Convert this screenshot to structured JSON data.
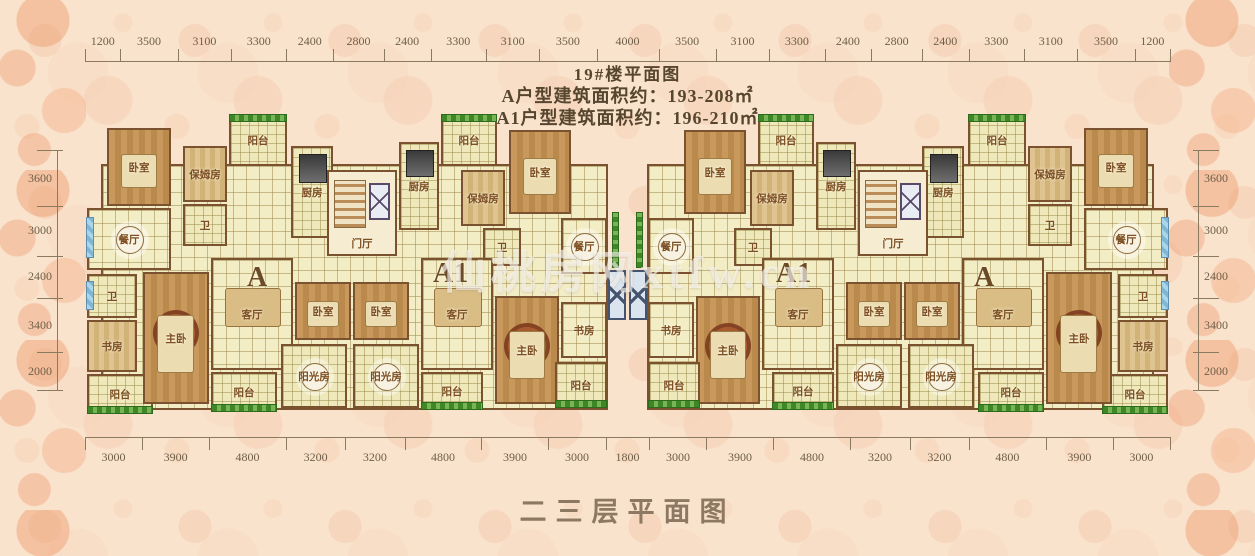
{
  "title": {
    "line1": "19#楼平面图",
    "line2": "A户型建筑面积约：193-208㎡",
    "line3": "A1户型建筑面积约：196-210㎡"
  },
  "footer_title": "二三层平面图",
  "watermark": "仙桃房网xtfw.cn",
  "palette": {
    "background": "#f9e3cd",
    "pattern": "#eca27a",
    "wall": "#7b5230",
    "tile_floor": "#f3edc6",
    "wood_floor": "#c8985c",
    "plant_green": "#3e8726",
    "window_blue": "#8cc4dd",
    "dimension_text": "#6f5f48",
    "title_text": "#57462f",
    "watermark_color": "#faf8f4"
  },
  "dimensions": {
    "top": [
      1200,
      3500,
      3100,
      3300,
      2400,
      2800,
      2400,
      3300,
      3100,
      3500,
      4000,
      3500,
      3100,
      3300,
      2400,
      2800,
      2400,
      3300,
      3100,
      3500,
      1200
    ],
    "bottom": [
      3000,
      3900,
      4800,
      3200,
      3200,
      4800,
      3900,
      3000,
      1800,
      3000,
      3900,
      4800,
      3200,
      3200,
      4800,
      3900,
      3000
    ],
    "left": [
      3600,
      3000,
      2400,
      3400,
      2000
    ],
    "right": [
      3600,
      3000,
      2400,
      3400,
      2000
    ]
  },
  "plan": {
    "width": 1085,
    "height": 318,
    "mirrored": true,
    "base": [
      {
        "n": "unit-base",
        "x": 16,
        "y": 52,
        "w": 507,
        "h": 246,
        "f": "tile"
      }
    ],
    "rooms": [
      {
        "n": "bedroom-nw",
        "x": 22,
        "y": 16,
        "w": 64,
        "h": 78,
        "f": "wood",
        "label": "卧室",
        "furn": "bed"
      },
      {
        "n": "nanny-a",
        "x": 98,
        "y": 34,
        "w": 44,
        "h": 56,
        "f": "woodl",
        "label": "保姆房"
      },
      {
        "n": "bath-a-top",
        "x": 98,
        "y": 92,
        "w": 44,
        "h": 42,
        "f": "tilesm",
        "label": "卫"
      },
      {
        "n": "balcony-a-top",
        "x": 144,
        "y": 2,
        "w": 58,
        "h": 52,
        "f": "tilesm",
        "label": "阳台",
        "plants": "top"
      },
      {
        "n": "kitchen-a",
        "x": 206,
        "y": 34,
        "w": 42,
        "h": 92,
        "f": "tilesm",
        "label": "厨房",
        "furn": "stove"
      },
      {
        "n": "dining-a",
        "x": 2,
        "y": 96,
        "w": 84,
        "h": 62,
        "f": "tile",
        "label": "餐厅",
        "furn": "rtable",
        "window": "left"
      },
      {
        "n": "bath-a-west",
        "x": 2,
        "y": 162,
        "w": 50,
        "h": 44,
        "f": "tilesm",
        "label": "卫",
        "window": "left"
      },
      {
        "n": "study-a",
        "x": 2,
        "y": 208,
        "w": 50,
        "h": 52,
        "f": "woodl",
        "label": "书房"
      },
      {
        "n": "balcony-a-sw",
        "x": 2,
        "y": 262,
        "w": 66,
        "h": 40,
        "f": "tilesm",
        "label": "阳台",
        "plants": "bottom"
      },
      {
        "n": "master-a",
        "x": 58,
        "y": 160,
        "w": 66,
        "h": 132,
        "f": "wood",
        "label": "主卧",
        "furn": "rug+bed"
      },
      {
        "n": "living-a",
        "x": 126,
        "y": 146,
        "w": 82,
        "h": 112,
        "f": "tile",
        "label": "客厅",
        "furn": "sofa"
      },
      {
        "n": "balcony-a-sc",
        "x": 126,
        "y": 260,
        "w": 66,
        "h": 40,
        "f": "tilesm",
        "label": "阳台",
        "plants": "bottom"
      },
      {
        "n": "bedroom-a-south",
        "x": 210,
        "y": 170,
        "w": 56,
        "h": 58,
        "f": "wood",
        "label": "卧室",
        "furn": "bed"
      },
      {
        "n": "sunroom-a",
        "x": 196,
        "y": 232,
        "w": 66,
        "h": 64,
        "f": "tilesm",
        "label": "阳光房",
        "furn": "rtable"
      },
      {
        "n": "entry-core",
        "x": 242,
        "y": 58,
        "w": 70,
        "h": 86,
        "f": "core",
        "label": "门厅",
        "furn": "stairs+xbox"
      },
      {
        "n": "kitchen-a1",
        "x": 314,
        "y": 30,
        "w": 40,
        "h": 88,
        "f": "tilesm",
        "label": "厨房",
        "furn": "stove"
      },
      {
        "n": "balcony-a1-top",
        "x": 356,
        "y": 2,
        "w": 56,
        "h": 52,
        "f": "tilesm",
        "label": "阳台",
        "plants": "top"
      },
      {
        "n": "nanny-a1",
        "x": 376,
        "y": 58,
        "w": 44,
        "h": 56,
        "f": "woodl",
        "label": "保姆房"
      },
      {
        "n": "bath-a1",
        "x": 398,
        "y": 116,
        "w": 38,
        "h": 38,
        "f": "tilesm",
        "label": "卫"
      },
      {
        "n": "bedroom-a1-north",
        "x": 424,
        "y": 18,
        "w": 62,
        "h": 84,
        "f": "wood",
        "label": "卧室",
        "furn": "bed"
      },
      {
        "n": "dining-a1",
        "x": 476,
        "y": 106,
        "w": 46,
        "h": 56,
        "f": "tile",
        "label": "餐厅",
        "furn": "rtable"
      },
      {
        "n": "bedroom-a1-south",
        "x": 268,
        "y": 170,
        "w": 56,
        "h": 58,
        "f": "wood",
        "label": "卧室",
        "furn": "bed"
      },
      {
        "n": "sunroom-a1",
        "x": 268,
        "y": 232,
        "w": 66,
        "h": 64,
        "f": "tilesm",
        "label": "阳光房",
        "furn": "rtable"
      },
      {
        "n": "living-a1",
        "x": 336,
        "y": 146,
        "w": 72,
        "h": 112,
        "f": "tile",
        "label": "客厅",
        "furn": "sofa"
      },
      {
        "n": "balcony-a1-sc",
        "x": 336,
        "y": 260,
        "w": 62,
        "h": 38,
        "f": "tilesm",
        "label": "阳台",
        "plants": "bottom"
      },
      {
        "n": "master-a1",
        "x": 410,
        "y": 184,
        "w": 64,
        "h": 108,
        "f": "wood",
        "label": "主卧",
        "furn": "rug+bed"
      },
      {
        "n": "study-a1",
        "x": 476,
        "y": 190,
        "w": 46,
        "h": 56,
        "f": "tile",
        "label": "书房"
      },
      {
        "n": "balcony-a1-se",
        "x": 470,
        "y": 250,
        "w": 52,
        "h": 46,
        "f": "tilesm",
        "label": "阳台",
        "plants": "bottom"
      }
    ],
    "center": [
      {
        "n": "center-planter-left",
        "x": 527,
        "y": 100,
        "w": 7,
        "h": 56,
        "f": "plantbed"
      },
      {
        "n": "center-planter-right",
        "x": 551,
        "y": 100,
        "w": 7,
        "h": 56,
        "f": "plantbed"
      },
      {
        "n": "elevator-left",
        "x": 523,
        "y": 158,
        "w": 18,
        "h": 50,
        "f": "elev"
      },
      {
        "n": "elevator-right",
        "x": 544,
        "y": 158,
        "w": 18,
        "h": 50,
        "f": "elev"
      }
    ],
    "unit_labels": [
      {
        "text": "A",
        "x": 162,
        "y": 150
      },
      {
        "text": "A1",
        "x": 348,
        "y": 146
      },
      {
        "text": "A1",
        "x": 691,
        "y": 146
      },
      {
        "text": "A",
        "x": 889,
        "y": 150
      }
    ]
  }
}
